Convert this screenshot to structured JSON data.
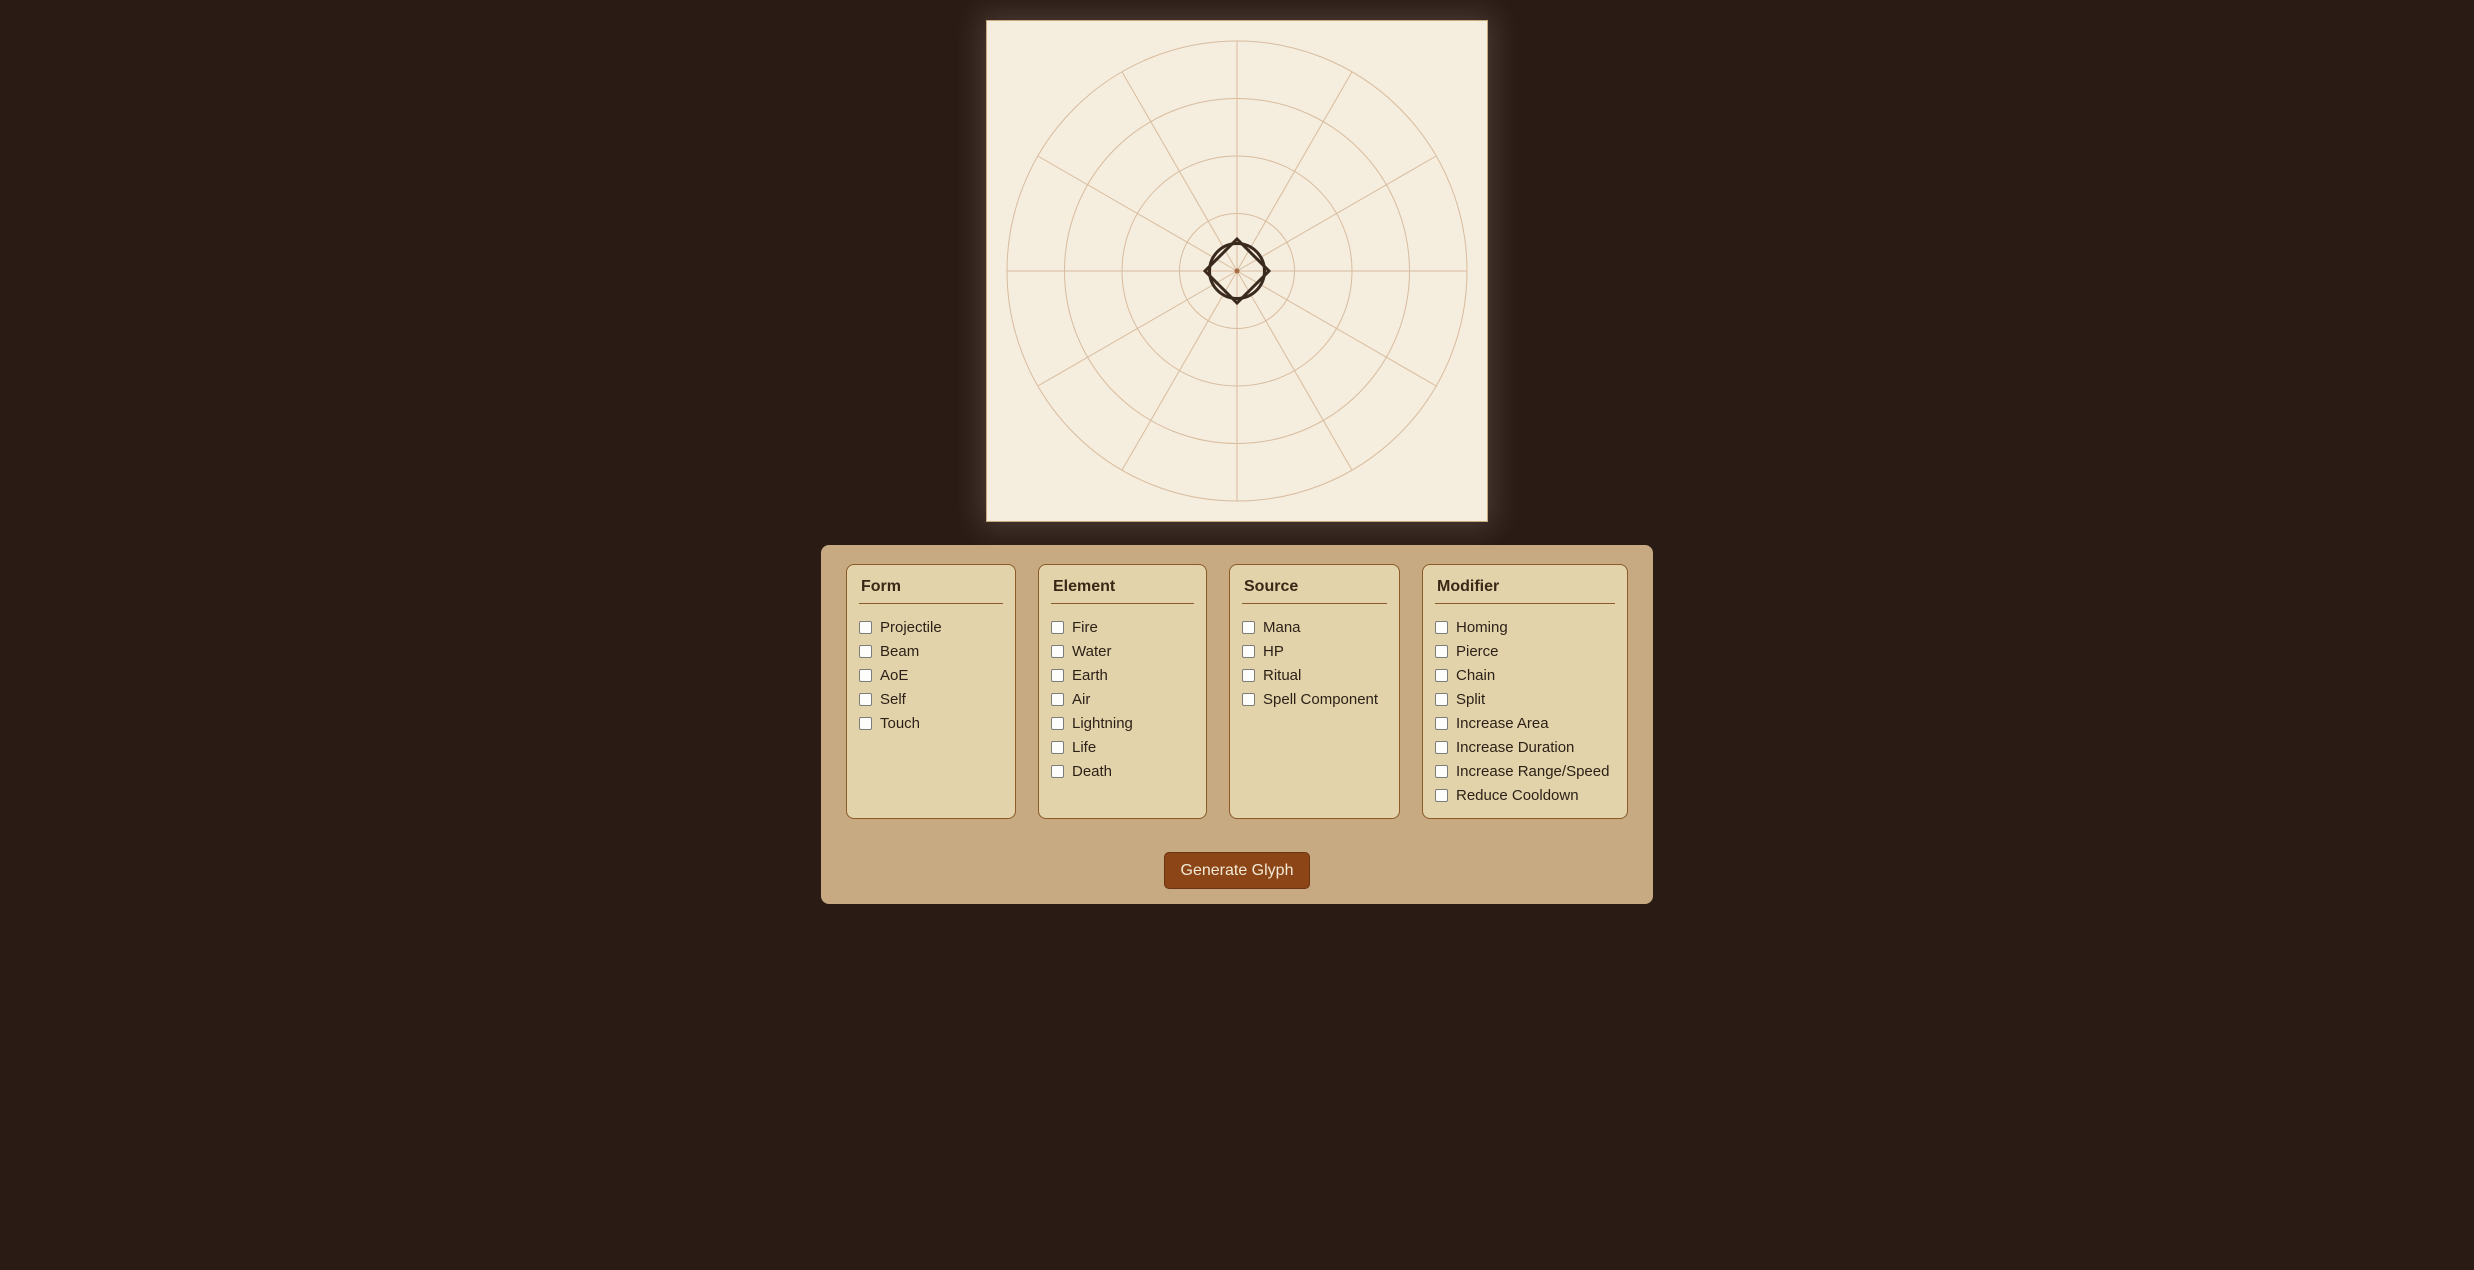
{
  "page": {
    "bg_color": "#2a1c15"
  },
  "canvas": {
    "bg_color": "#f5edde",
    "border_color": "#c9a87e",
    "grid_color": "#d8bc9e",
    "size": 500,
    "grid_circle_radii": [
      57.5,
      115,
      172.5,
      230
    ],
    "grid_spoke_count": 12,
    "grid_spoke_length": 230,
    "glyph": {
      "stroke_color": "#3a2a1e",
      "stroke_width": 3,
      "diamond_half_diagonal": 32,
      "circle_radius": 27.5,
      "center_dot_color": "#a66b42",
      "center_dot_radius": 2.5
    }
  },
  "panel": {
    "bg_color": "#c7aa82",
    "group_bg_color": "#e3d3ab",
    "group_border_color": "#8a5a28",
    "groups": [
      {
        "title": "Form",
        "options": [
          "Projectile",
          "Beam",
          "AoE",
          "Self",
          "Touch"
        ],
        "checked": [
          false,
          false,
          false,
          false,
          false
        ]
      },
      {
        "title": "Element",
        "options": [
          "Fire",
          "Water",
          "Earth",
          "Air",
          "Lightning",
          "Life",
          "Death"
        ],
        "checked": [
          false,
          false,
          false,
          false,
          false,
          false,
          false
        ]
      },
      {
        "title": "Source",
        "options": [
          "Mana",
          "HP",
          "Ritual",
          "Spell Component"
        ],
        "checked": [
          false,
          false,
          false,
          false
        ]
      },
      {
        "title": "Modifier",
        "options": [
          "Homing",
          "Pierce",
          "Chain",
          "Split",
          "Increase Area",
          "Increase Duration",
          "Increase Range/Speed",
          "Reduce Cooldown"
        ],
        "checked": [
          false,
          false,
          false,
          false,
          false,
          false,
          false,
          false
        ]
      }
    ],
    "button": {
      "label": "Generate Glyph",
      "bg_color": "#8b4516",
      "text_color": "#f3ead6"
    }
  }
}
